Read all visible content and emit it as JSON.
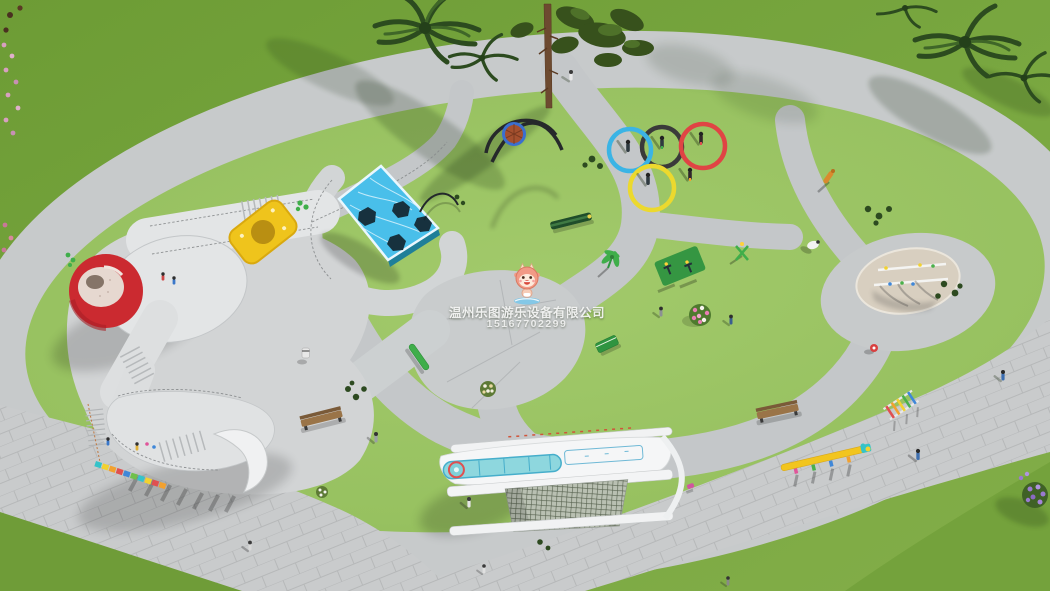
{
  "scene": {
    "type": "3d-aerial-render",
    "subject": "children playground landscape design, bird's-eye view"
  },
  "watermark": {
    "company": "温州乐图游乐设备有限公司",
    "phone": "15167702299",
    "mascot": "letu-baby-dragon-mascot"
  },
  "palette": {
    "grass_outer": "#76a43c",
    "grass_inner": "#98c263",
    "path_gray": "#c7cacb",
    "plaza_tile": "#c9cbcc",
    "volcano_red": "#cb2a30",
    "trampoline_blue": "#49bfea",
    "climber_yellow": "#efc41c",
    "slide_teal": "#8ed7de",
    "equipment_green": "#2f9440",
    "sand": "#d8cfc0",
    "ring_blue": "#3bb4e5",
    "ring_black": "#3a3a3a",
    "ring_red": "#e04444",
    "ring_yellow": "#ecd92e",
    "beam_yellow": "#f2c51e",
    "bench_wood": "#9a7448"
  },
  "objects": [
    "volcano-slide-tower",
    "trampoline-platform",
    "nest-swing",
    "olympic-rings-ground-art",
    "sand-pit",
    "ship-play-structure",
    "curved-slide",
    "rainbow-steps",
    "wooden-bench",
    "yellow-balance-beam",
    "green-balance-beam",
    "fitness-equipment",
    "windmill-spinner",
    "sheep-sculpture",
    "giraffe-sculpture",
    "pine-tree",
    "palm-trees",
    "flower-bushes",
    "pedestrians",
    "paved-walkways",
    "lawn"
  ]
}
